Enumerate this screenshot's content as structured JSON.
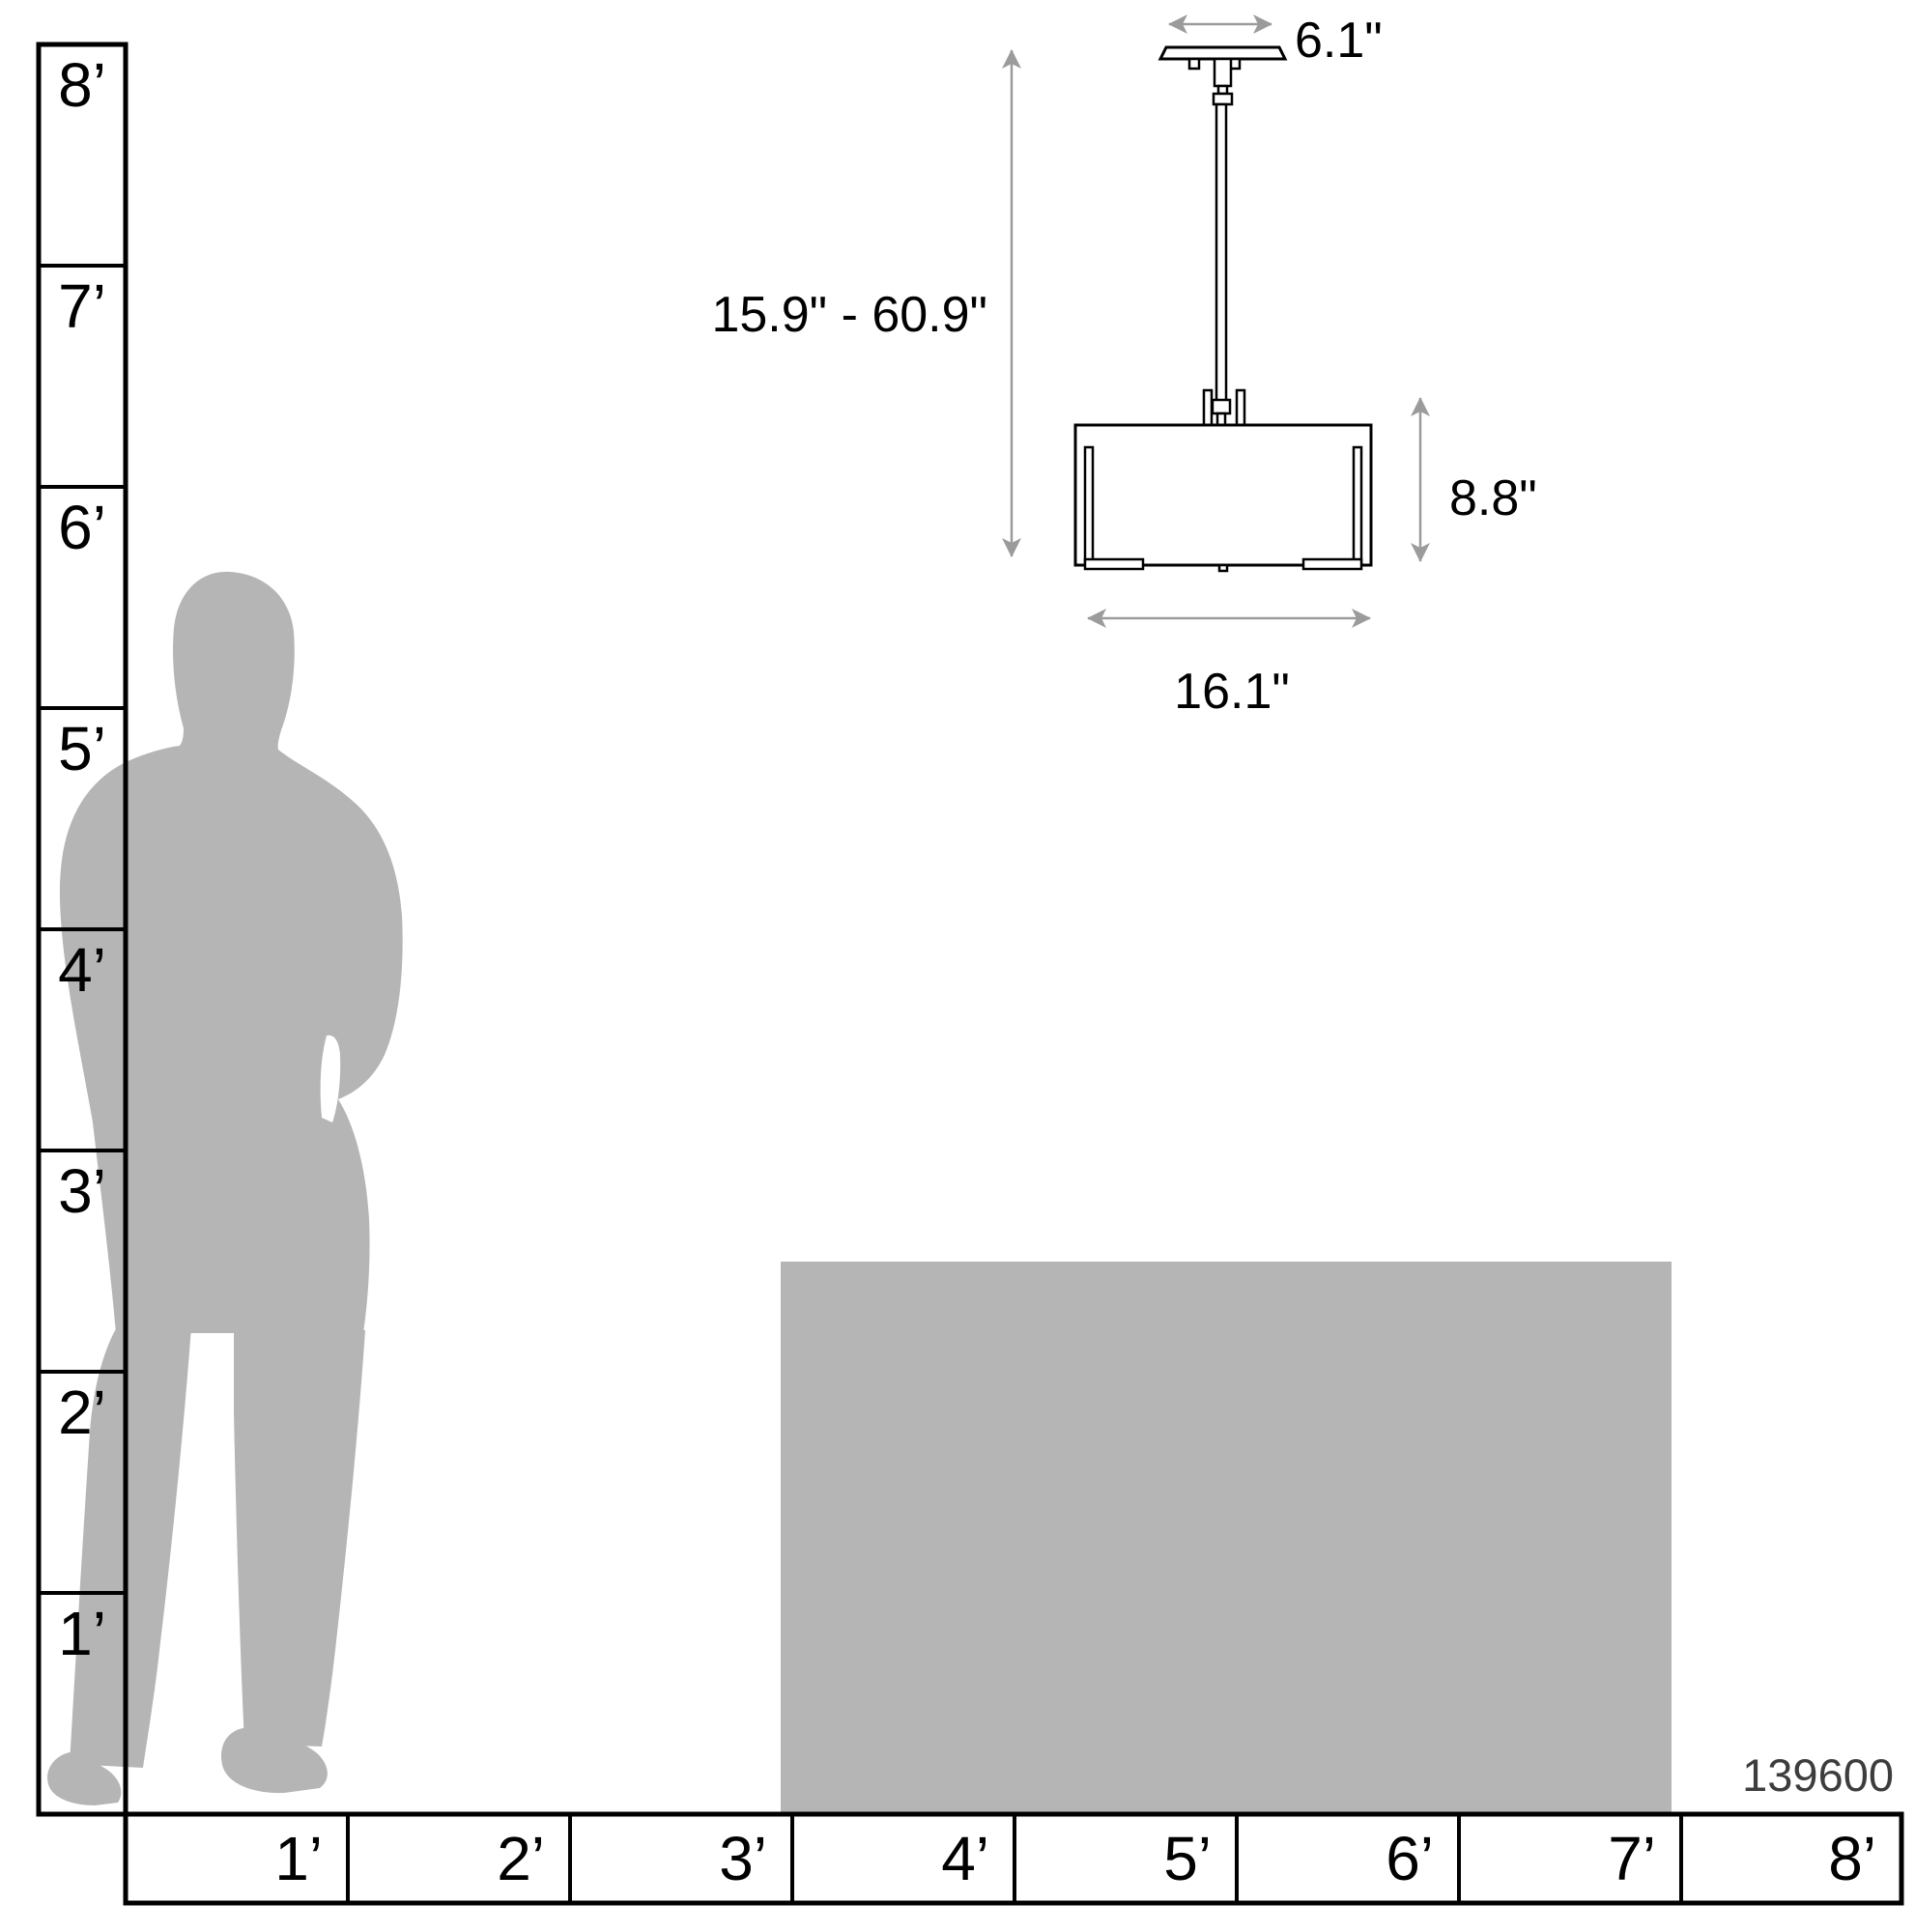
{
  "diagram": {
    "product_code": "139600",
    "dimensions": {
      "canopy_width": "6.1\"",
      "height_range": "15.9\" - 60.9\"",
      "shade_height": "8.8\"",
      "shade_width": "16.1\""
    }
  },
  "rulers": {
    "vertical_feet_labels": [
      "8’",
      "7’",
      "6’",
      "5’",
      "4’",
      "3’",
      "2’",
      "1’"
    ],
    "horizontal_feet_labels": [
      "1’",
      "2’",
      "3’",
      "4’",
      "5’",
      "6’",
      "7’",
      "8’"
    ]
  },
  "colors": {
    "silhouette-color": "#b5b5b5",
    "counter-color": "#b5b5b5",
    "line-color": "#000000",
    "arrow-color": "#9b9b9b",
    "sku-color": "#3d3d3d",
    "background": "#ffffff"
  }
}
